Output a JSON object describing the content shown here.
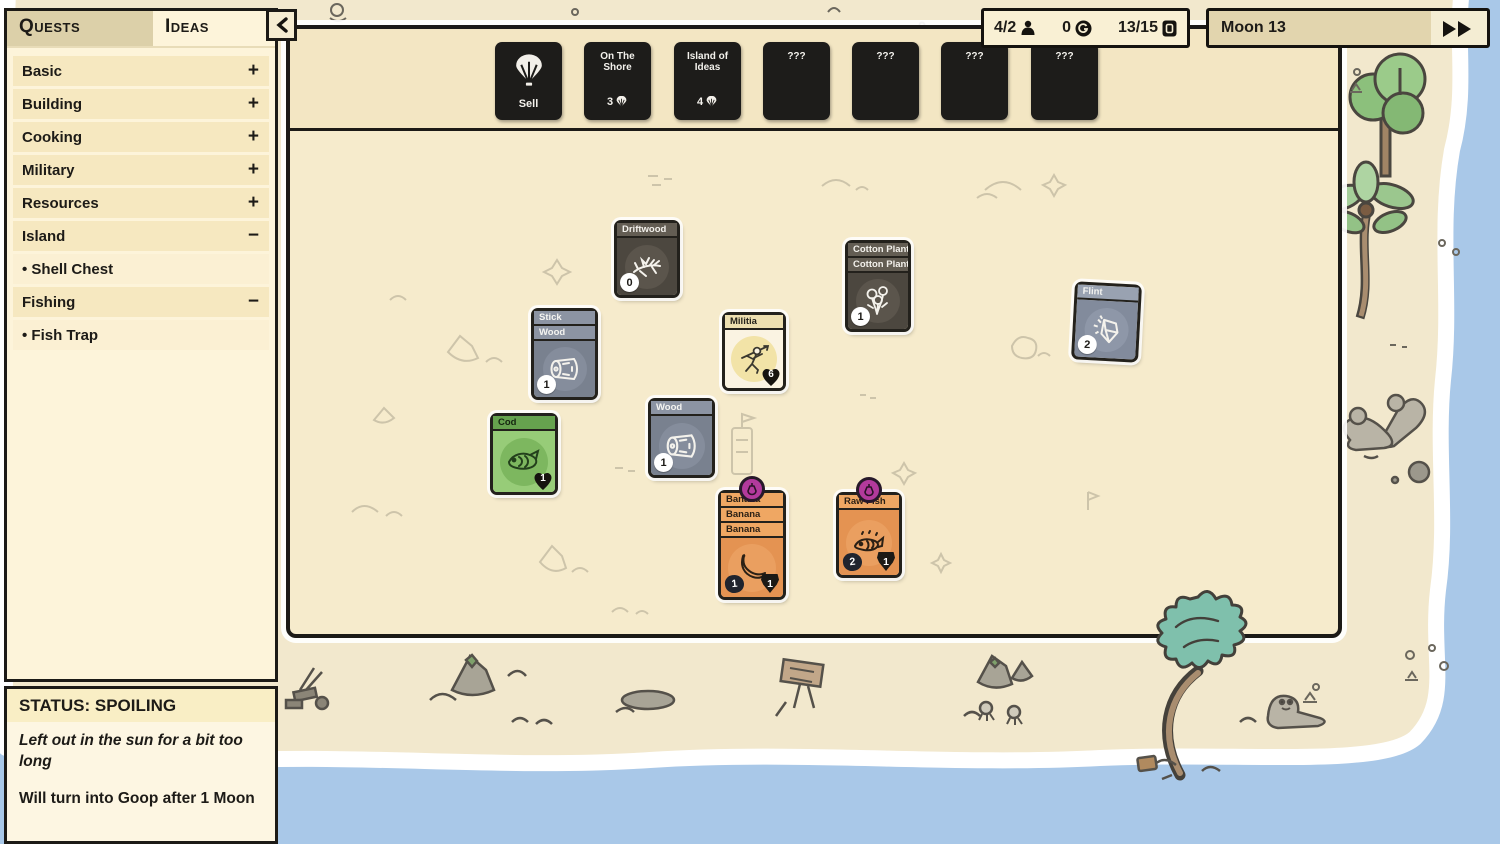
{
  "quest_panel": {
    "tab_quests": "Quests",
    "tab_ideas": "Ideas",
    "items": [
      {
        "label": "Basic",
        "toggle": "+"
      },
      {
        "label": "Building",
        "toggle": "+"
      },
      {
        "label": "Cooking",
        "toggle": "+"
      },
      {
        "label": "Military",
        "toggle": "+"
      },
      {
        "label": "Resources",
        "toggle": "+"
      },
      {
        "label": "Island",
        "toggle": "−"
      },
      {
        "label": "• Shell Chest",
        "toggle": ""
      },
      {
        "label": "Fishing",
        "toggle": "−"
      },
      {
        "label": "• Fish Trap",
        "toggle": ""
      }
    ]
  },
  "header": {
    "villagers": "4/2",
    "coins": "0",
    "cards": "13/15",
    "moon_label": "Moon 13"
  },
  "shop": {
    "sell_label": "Sell",
    "packs": [
      {
        "title": "On The Shore",
        "cost": "3"
      },
      {
        "title": "Island of Ideas",
        "cost": "4"
      },
      {
        "title": "???",
        "cost": ""
      },
      {
        "title": "???",
        "cost": ""
      },
      {
        "title": "???",
        "cost": ""
      },
      {
        "title": "???",
        "cost": ""
      }
    ]
  },
  "board_cards": [
    {
      "titles": [
        "Driftwood"
      ],
      "count": "0"
    },
    {
      "titles": [
        "Cotton Plant",
        "Cotton Plant"
      ],
      "count": "1"
    },
    {
      "titles": [
        "Flint"
      ],
      "count": "2"
    },
    {
      "titles": [
        "Stick",
        "Wood"
      ],
      "count": "1"
    },
    {
      "titles": [
        "Militia"
      ],
      "health": "6"
    },
    {
      "titles": [
        "Wood"
      ],
      "count": "1"
    },
    {
      "titles": [
        "Cod"
      ],
      "health": "1"
    },
    {
      "titles": [
        "Banana",
        "Banana",
        "Banana"
      ],
      "food": "1",
      "value": "1"
    },
    {
      "titles": [
        "Raw Fish"
      ],
      "food": "2",
      "value": "1"
    }
  ],
  "status_panel": {
    "title": "STATUS: SPOILING",
    "flavor": "Left out in the sun for a bit too long",
    "effect": "Will turn into Goop after 1 Moon"
  },
  "colors": {
    "spoil_purple": "#b23a9c",
    "water_blue": "#a9c8e8",
    "sand": "#f2e8cd",
    "card_dark": "#1d1c1a",
    "card_wood_gray": "#79818f",
    "card_food_orange": "#e49352",
    "card_cod_green": "#97cc78"
  }
}
